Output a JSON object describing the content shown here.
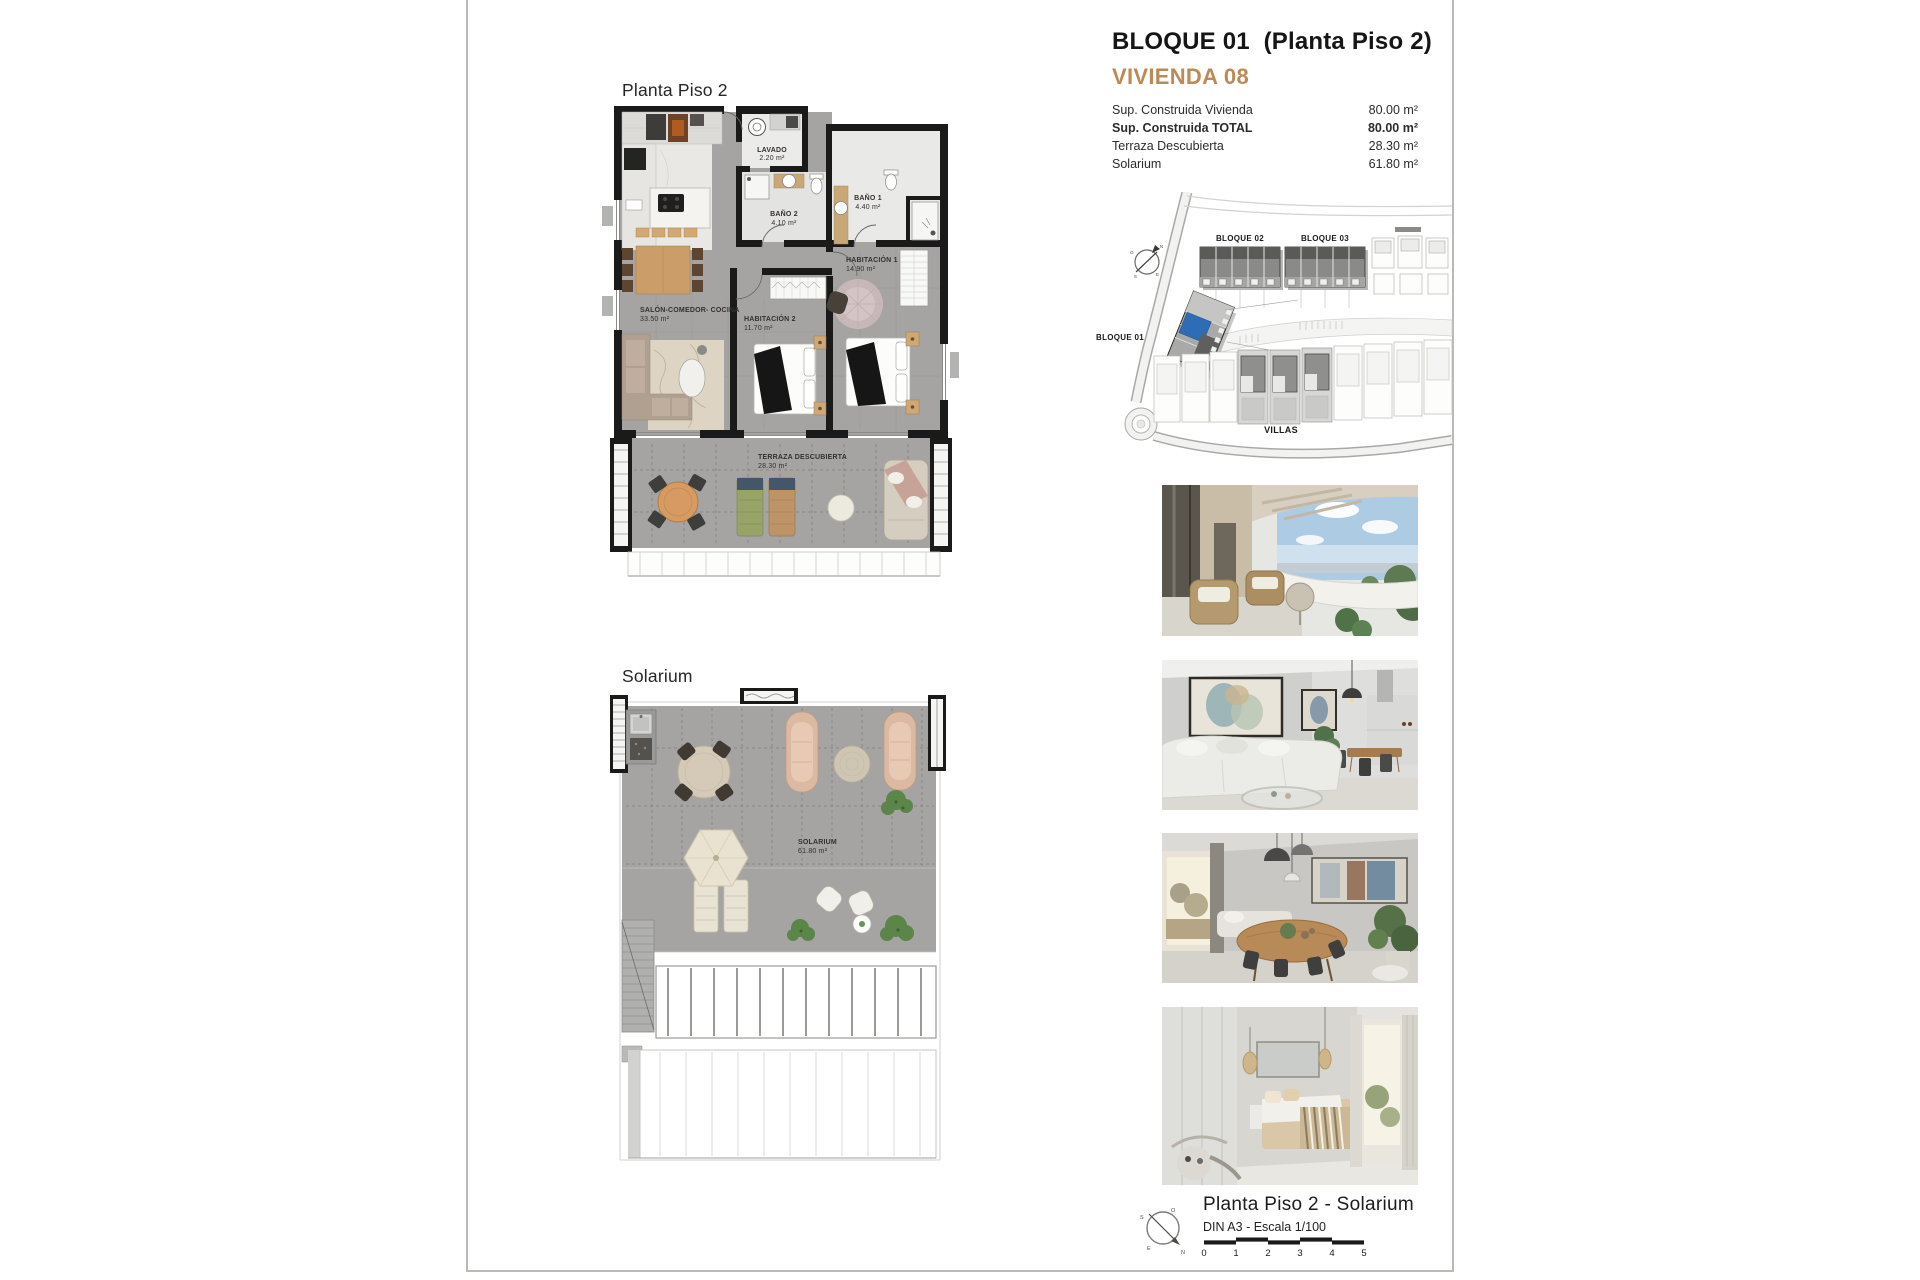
{
  "header": {
    "title": "BLOQUE 01  (Planta Piso 2)",
    "unit": "VIVIENDA 08",
    "accent_color": "#bc8a55",
    "rows": [
      {
        "label": "Sup. Construida Vivienda",
        "value": "80.00 m²"
      },
      {
        "label": "Sup. Construida TOTAL",
        "value": "80.00 m²"
      },
      {
        "label": "Terraza Descubierta",
        "value": "28.30 m²"
      },
      {
        "label": "Solarium",
        "value": "61.80 m²"
      }
    ]
  },
  "plan_piso2": {
    "title": "Planta Piso 2",
    "rooms": {
      "lavado": {
        "name": "LAVADO",
        "area": "2.20 m²"
      },
      "bano2": {
        "name": "BAÑO 2",
        "area": "4.10 m²"
      },
      "bano1": {
        "name": "BAÑO 1",
        "area": "4.40 m²"
      },
      "hab1": {
        "name": "HABITACIÓN 1",
        "area": "14.90 m²"
      },
      "hab2": {
        "name": "HABITACIÓN 2",
        "area": "11.70 m²"
      },
      "salon": {
        "name": "SALÓN-COMEDOR- COCINA",
        "area": "33.50 m²"
      },
      "terraza": {
        "name": "TERRAZA DESCUBIERTA",
        "area": "28.30 m²"
      }
    }
  },
  "plan_solarium": {
    "title": "Solarium",
    "rooms": {
      "solarium": {
        "name": "SOLARIUM",
        "area": "61.80 m²"
      }
    }
  },
  "siteplan": {
    "bloque01": "BLOQUE 01",
    "bloque02": "BLOQUE 02",
    "bloque03": "BLOQUE 03",
    "villas": "VILLAS",
    "highlight_color": "#2e6cb5"
  },
  "compass": {
    "n": "N",
    "s": "S",
    "e": "E",
    "o": "O"
  },
  "titleblock": {
    "title": "Planta Piso 2 - Solarium",
    "scale_note": "DIN A3 - Escala 1/100",
    "ticks": [
      "0",
      "1",
      "2",
      "3",
      "4",
      "5"
    ]
  },
  "photos": {
    "p1": "terrace-exterior-render",
    "p2": "living-room-render",
    "p3": "dining-room-render",
    "p4": "bedroom-render"
  }
}
